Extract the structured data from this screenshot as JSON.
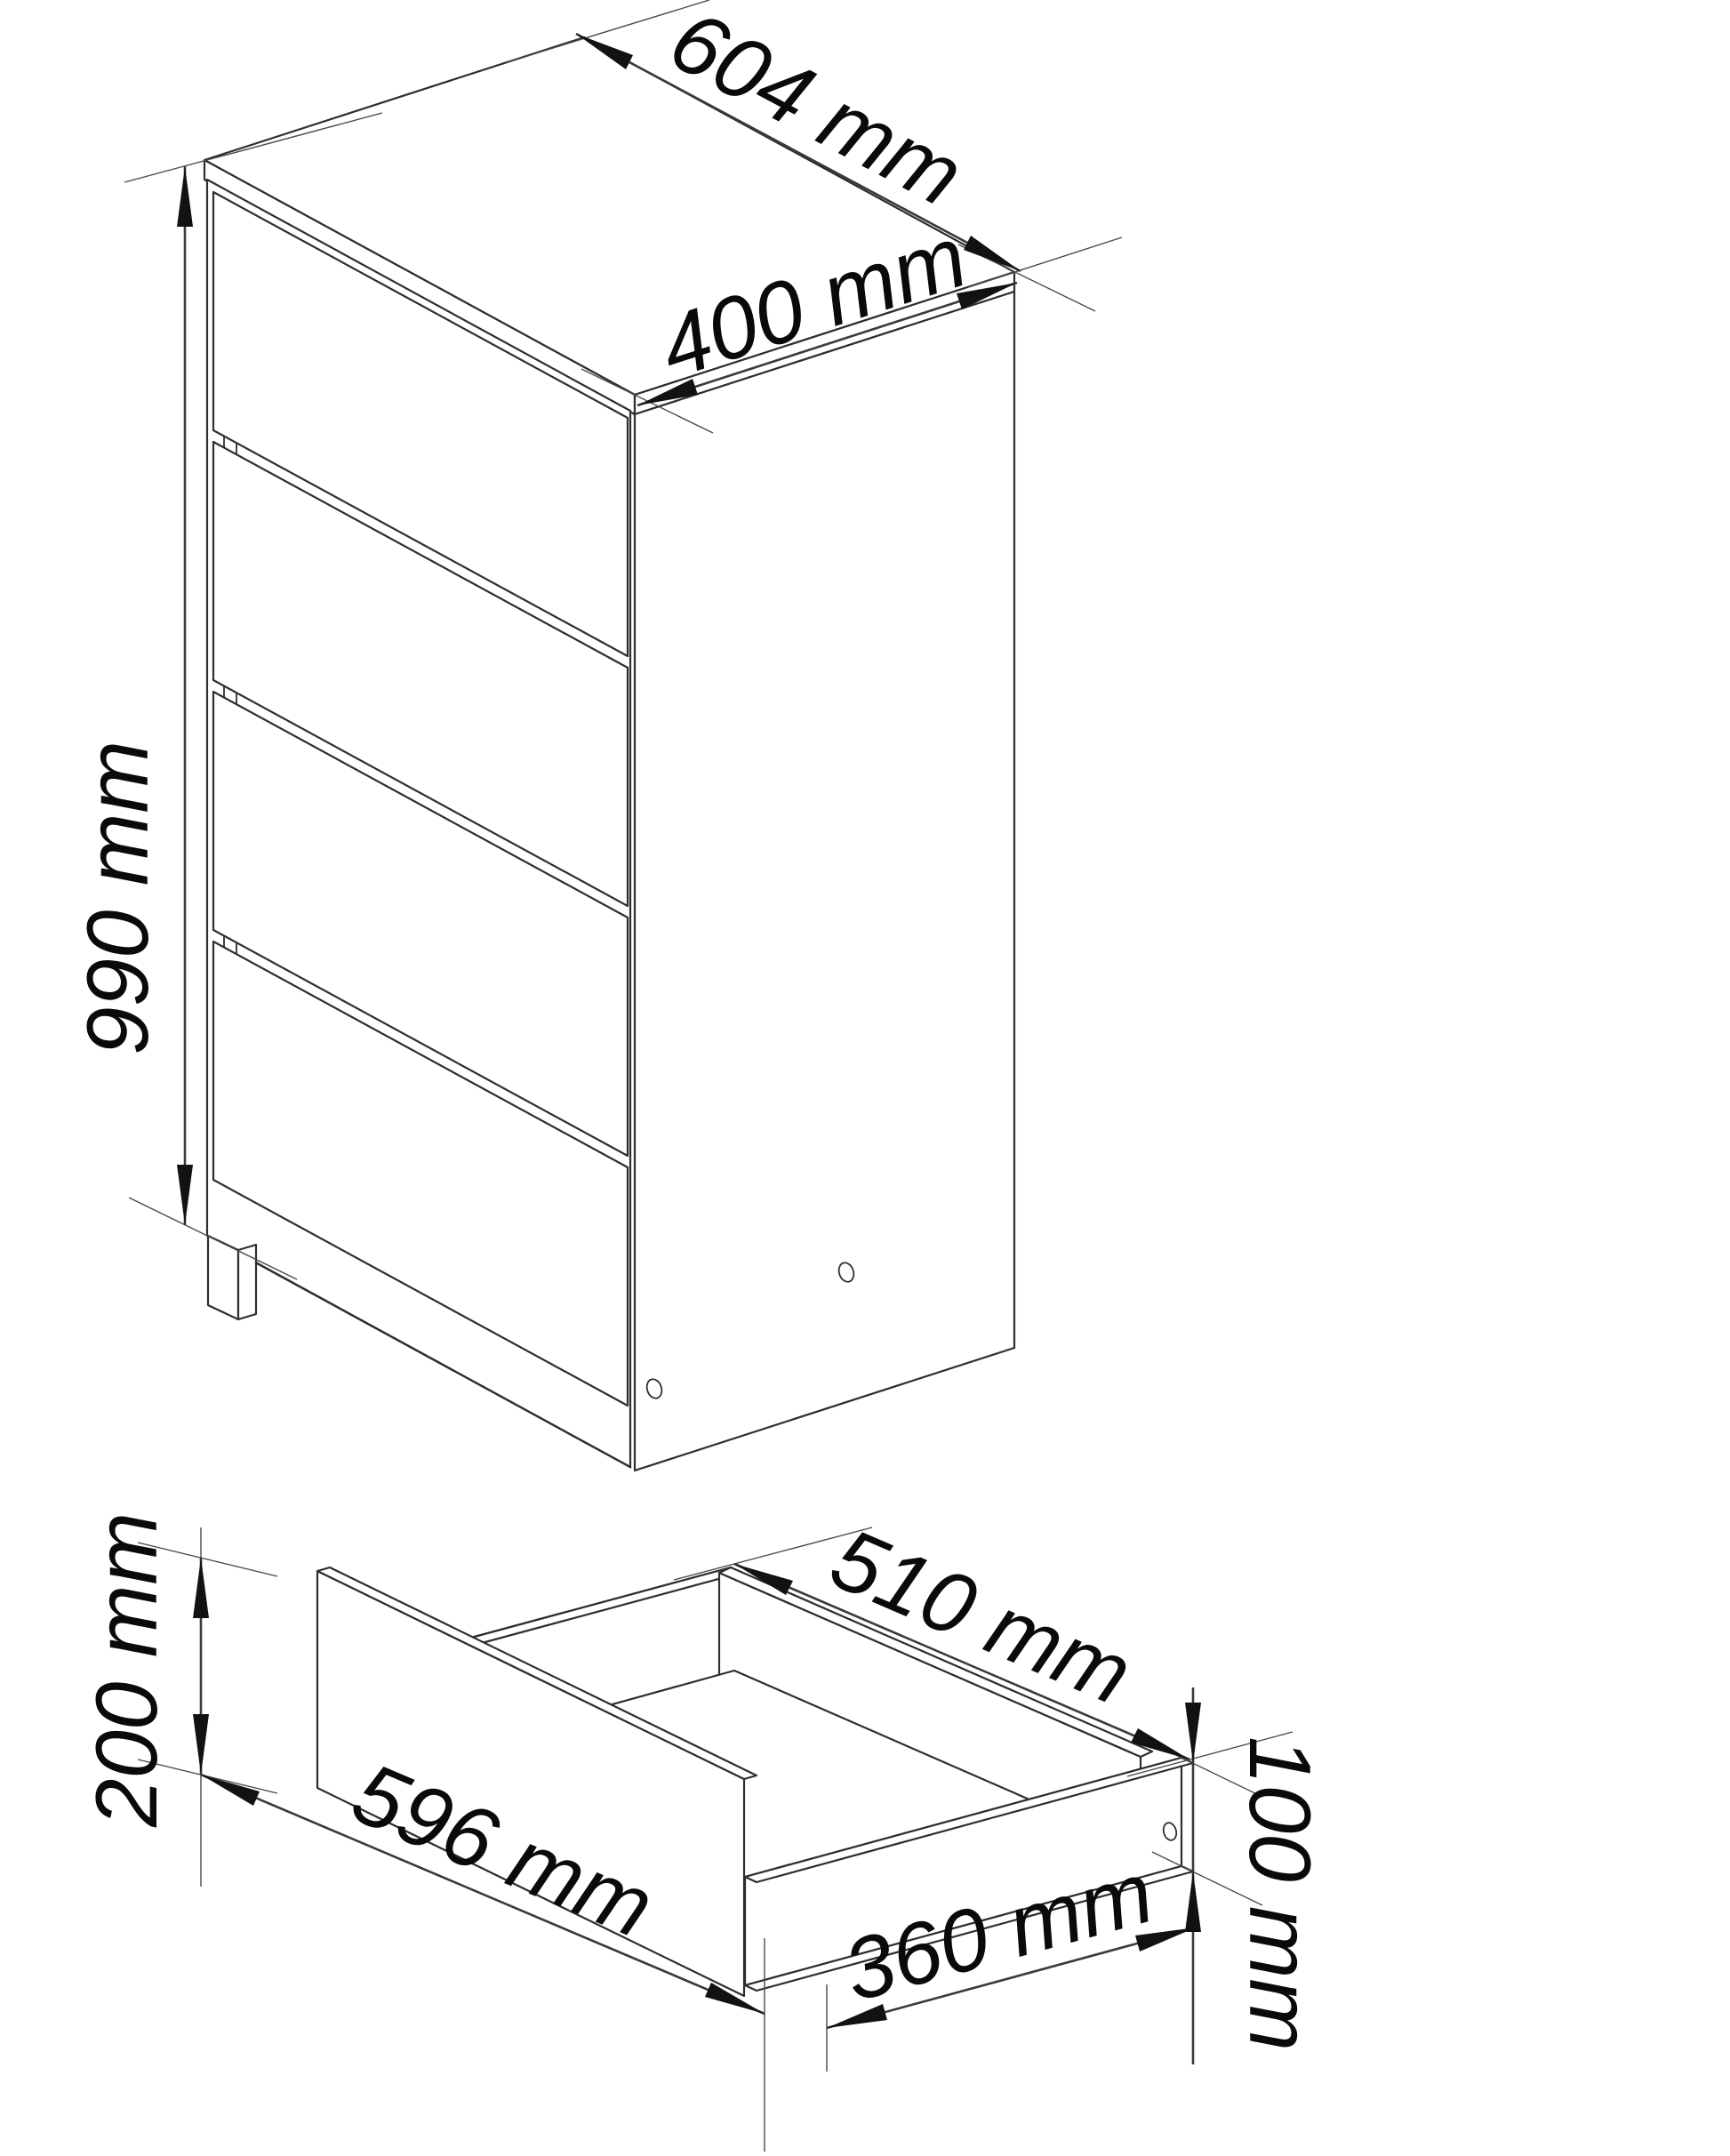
{
  "page": {
    "background": "#ffffff",
    "line_color": "#2e2e2e",
    "text_color": "#0a0a0a"
  },
  "drawing": {
    "type": "technical-line-drawing",
    "views": {
      "cabinet": {
        "title": "four-drawer-chest-isometric-view",
        "drawer_count": 4,
        "dims": {
          "width": "604 mm",
          "depth": "400 mm",
          "height": "990 mm"
        }
      },
      "drawer": {
        "title": "single-drawer-isometric-view",
        "dims": {
          "front_width": "596 mm",
          "front_height": "200 mm",
          "inner_width": "510 mm",
          "side_depth": "360 mm",
          "side_height": "100 mm"
        }
      }
    }
  }
}
